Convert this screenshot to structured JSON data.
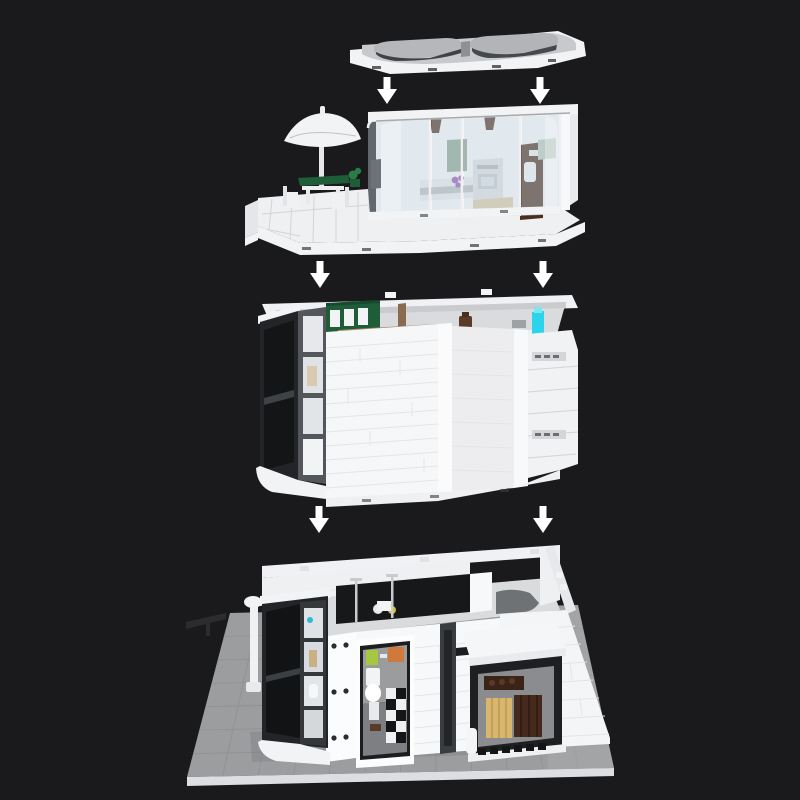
{
  "palette": {
    "bg": "#1a1a1c",
    "arrow": "#ffffff",
    "white": "#f2f3f5",
    "white-shade": "#e0e2e5",
    "white-dark": "#c7c9cd",
    "roof-top": "#c7c9cc",
    "roof-strip": "#3f4246",
    "black": "#1b1c1e",
    "frame-dark": "#3a3d40",
    "glass": "#c3d4de",
    "green": "#1f5c38",
    "sage": "#8aa28e",
    "wood": "#a98a6d",
    "brown": "#5a3a28",
    "purple": "#9355b0",
    "cyan": "#2bd4ea",
    "lime": "#a6c83e",
    "orange": "#cf7a3c",
    "gold": "#d8b66e",
    "plate": "#9c9d9f",
    "plate-line": "#8d8e90",
    "interior": "#d9dbdd"
  },
  "arrows": {
    "color": "#ffffff",
    "items": [
      {
        "x": 387,
        "y": 77
      },
      {
        "x": 540,
        "y": 77
      },
      {
        "x": 320,
        "y": 261
      },
      {
        "x": 543,
        "y": 261
      },
      {
        "x": 319,
        "y": 506
      },
      {
        "x": 543,
        "y": 506
      }
    ]
  },
  "baseplate": {
    "corners": [
      [
        230,
        613
      ],
      [
        578,
        605
      ],
      [
        614,
        768
      ],
      [
        187,
        777
      ]
    ],
    "rows": 7,
    "cols": 12
  },
  "sections": [
    {
      "id": "roof-panel"
    },
    {
      "id": "top-floor-terrace"
    },
    {
      "id": "middle-floor"
    },
    {
      "id": "ground-floor-baseplate"
    }
  ]
}
